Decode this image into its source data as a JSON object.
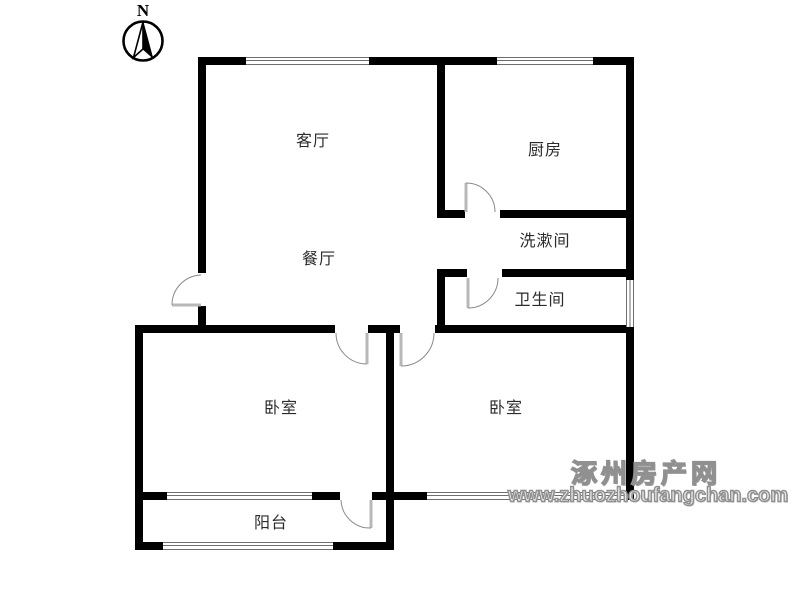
{
  "compass": {
    "letter": "N",
    "icon": "compass-north-icon"
  },
  "rooms": {
    "living": {
      "label": "客厅"
    },
    "kitchen": {
      "label": "厨房"
    },
    "dining": {
      "label": "餐厅"
    },
    "washroom": {
      "label": "洗漱间"
    },
    "bathroom": {
      "label": "卫生间"
    },
    "bedroom_left": {
      "label": "卧室"
    },
    "bedroom_right": {
      "label": "卧室"
    },
    "balcony": {
      "label": "阳台"
    }
  },
  "watermark": {
    "site_name": "涿州房产网",
    "url": "www.zhuozhoufangchan.com"
  },
  "colors": {
    "wall": "#000000",
    "door_leaf": "#b8b8b8",
    "door_arc": "#8a8a8a",
    "window_line": "#6e6e6e",
    "watermark_gray": "#909090",
    "label_text": "#2b2b2b"
  }
}
